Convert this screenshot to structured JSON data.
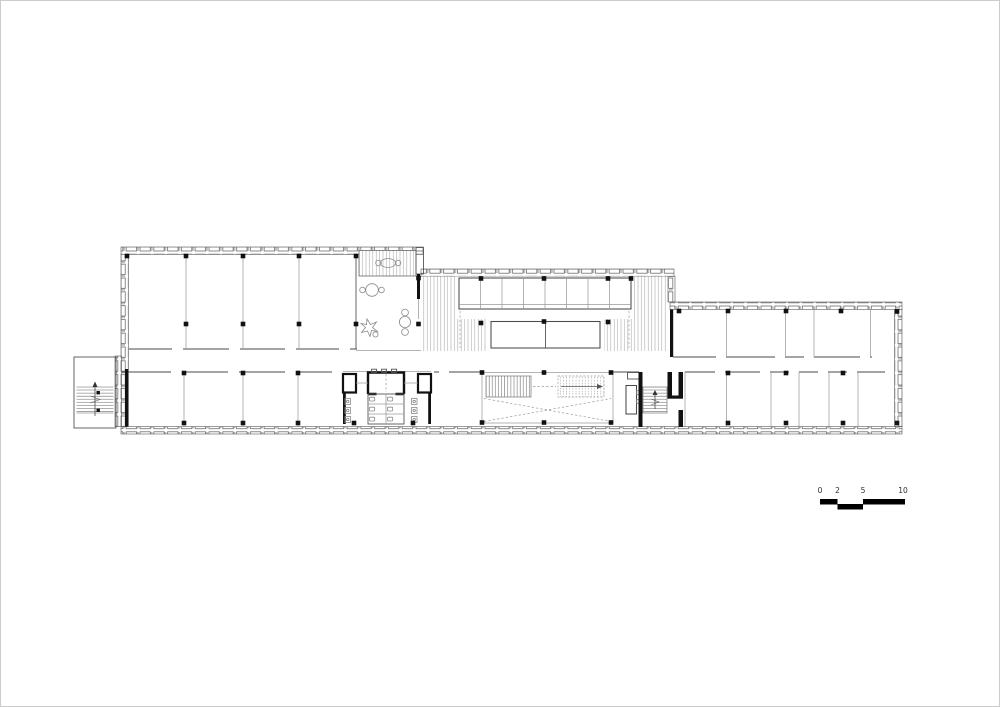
{
  "document": {
    "type": "architectural-floor-plan",
    "background": "#ffffff",
    "frame_color": "#cccccc"
  },
  "palette": {
    "wall": "#555555",
    "heavy_wall": "#111111",
    "partition": "#9a9a9a",
    "hatch": "#a8a8a8",
    "column": "#111111",
    "dashed": "#9b9b9b",
    "furniture": "#8a8a8a"
  },
  "scale_bar": {
    "labels": [
      "0",
      "2",
      "5",
      "10"
    ],
    "bar_color": "#000000",
    "text_color": "#2e2e2e"
  }
}
